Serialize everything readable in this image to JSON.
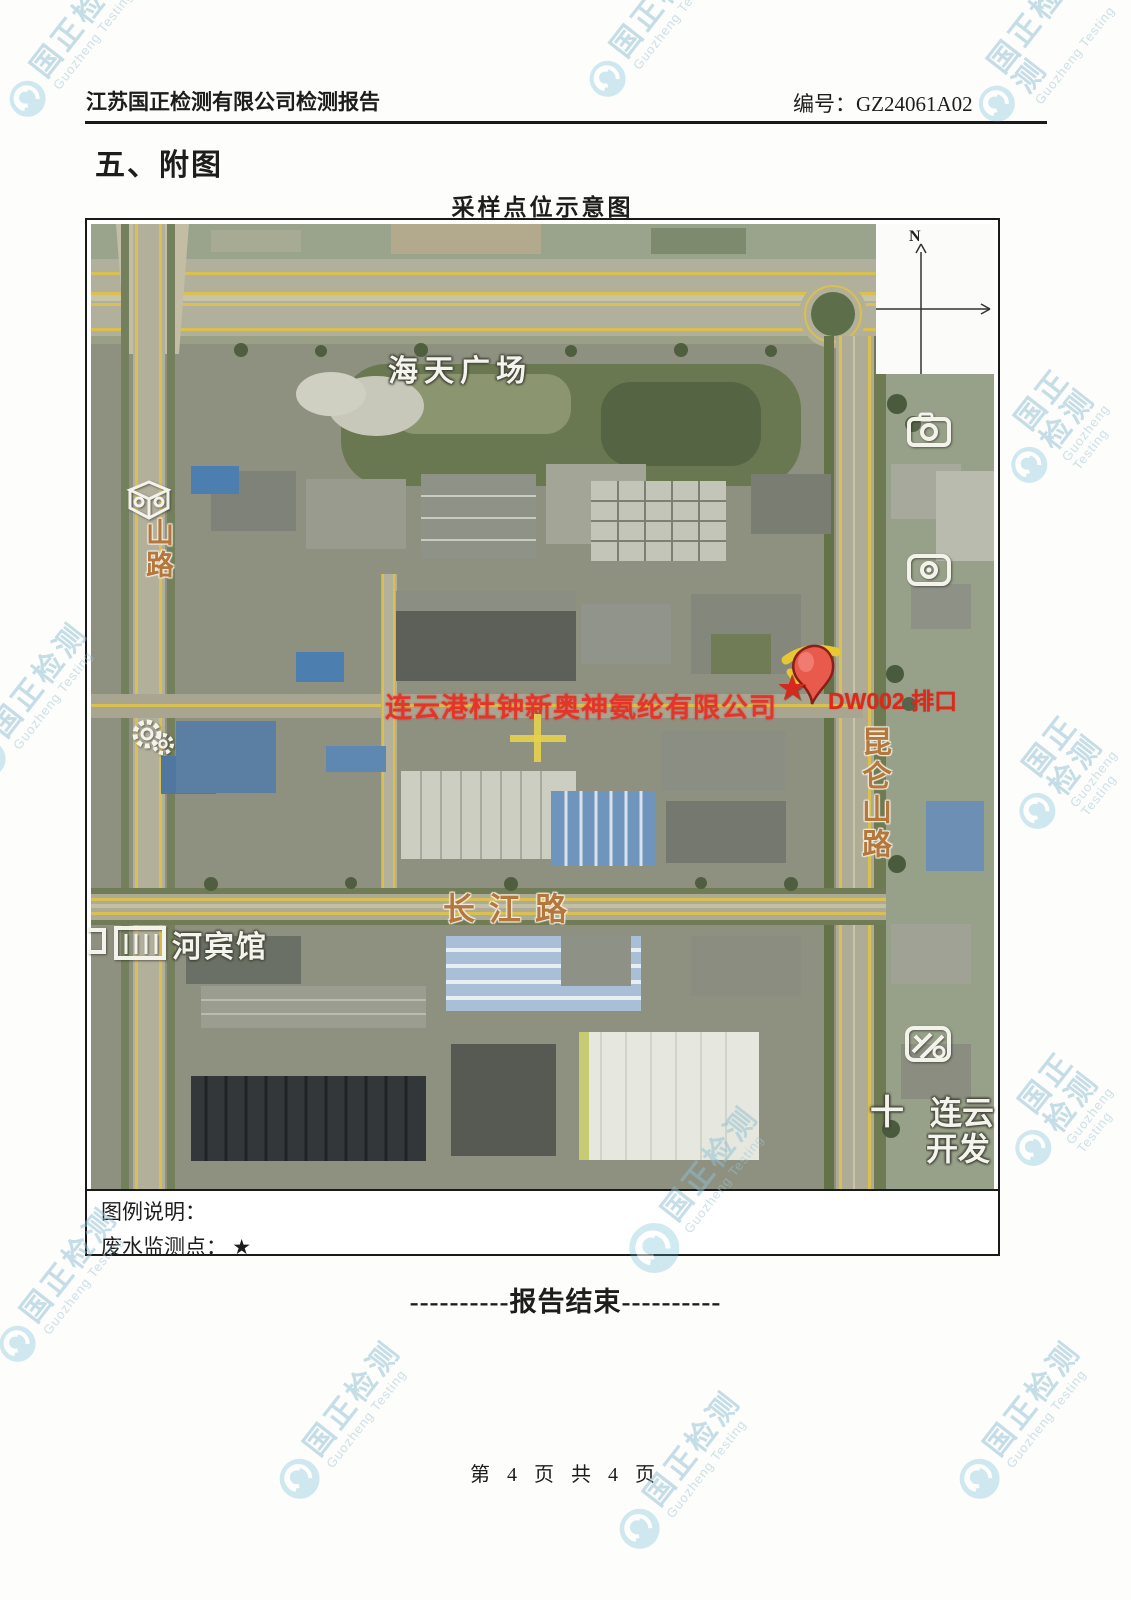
{
  "colors": {
    "watermark_teal": "#8fbfd2",
    "company_red": "#e5352b",
    "outfall_red": "#e0271c",
    "road_label_orange": "#b5773d",
    "lane_yellow": "#d9c050",
    "marker_star_red": "#d6281d",
    "legend_star_black": "#1c1c1c"
  },
  "watermark": {
    "text_cn": "国正检测",
    "text_en": "Guozheng Testing"
  },
  "header": {
    "report_title": "江苏国正检测有限公司检测报告",
    "report_no_label": "编号：",
    "report_no": "GZ24061A02"
  },
  "section_title": "五、附图",
  "map": {
    "title": "采样点位示意图",
    "compass_n": "N",
    "labels": {
      "plaza": "海天广场",
      "road_left_vertical": "山路",
      "road_right_vertical": "昆仑山路",
      "road_bottom": "长江路",
      "hotel": "河宾馆",
      "company": "连云港杜钟新奥神氨纶有限公司",
      "outfall": "DW002 排口",
      "outfall_star": "★",
      "corner_cross": "十",
      "corner_line1": "连云",
      "corner_line2": "开发"
    }
  },
  "legend": {
    "title": "图例说明：",
    "item_label": "废水监测点：",
    "item_symbol": "★"
  },
  "end_note": "----------报告结束----------",
  "footer": {
    "page_info": "第 4 页 共 4 页"
  }
}
